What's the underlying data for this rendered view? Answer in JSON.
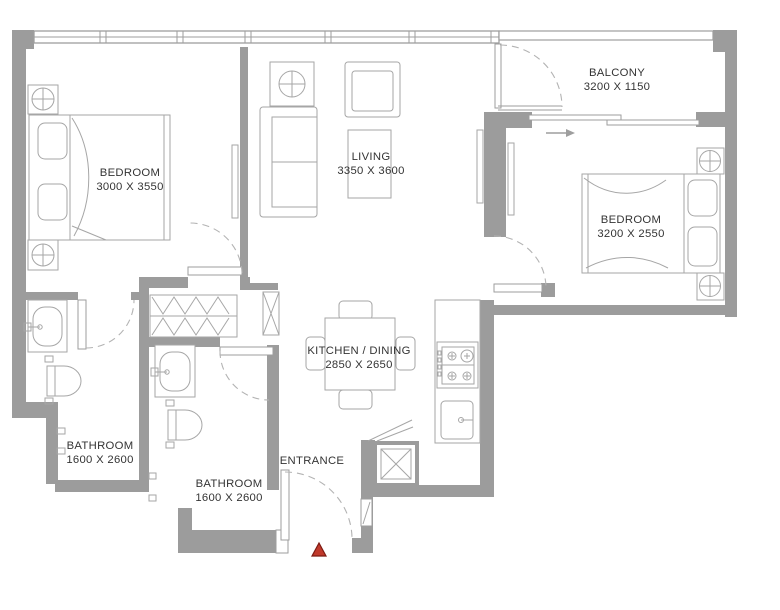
{
  "plan": {
    "title": "2-bedroom apartment floor plan",
    "rooms": [
      {
        "id": "bedroom-1",
        "label": "BEDROOM",
        "dims": "3000 X 3550"
      },
      {
        "id": "living",
        "label": "LIVING",
        "dims": "3350 X 3600"
      },
      {
        "id": "balcony",
        "label": "BALCONY",
        "dims": "3200 X 1150"
      },
      {
        "id": "bedroom-2",
        "label": "BEDROOM",
        "dims": "3200 X 2550"
      },
      {
        "id": "kitchen-dining",
        "label": "KITCHEN / DINING",
        "dims": "2850 X 2650"
      },
      {
        "id": "bathroom-1",
        "label": "BATHROOM",
        "dims": "1600 X 2600"
      },
      {
        "id": "bathroom-2",
        "label": "BATHROOM",
        "dims": "1600 X 2600"
      }
    ],
    "entrance": {
      "label": "ENTRANCE"
    },
    "marker": {
      "type": "entrance-arrow",
      "fill": "#c0392b",
      "stroke": "#7c1a12"
    },
    "colors": {
      "wall": "#9c9c9c",
      "line": "#a6a6a6",
      "text": "#343434",
      "background": "#ffffff"
    }
  }
}
